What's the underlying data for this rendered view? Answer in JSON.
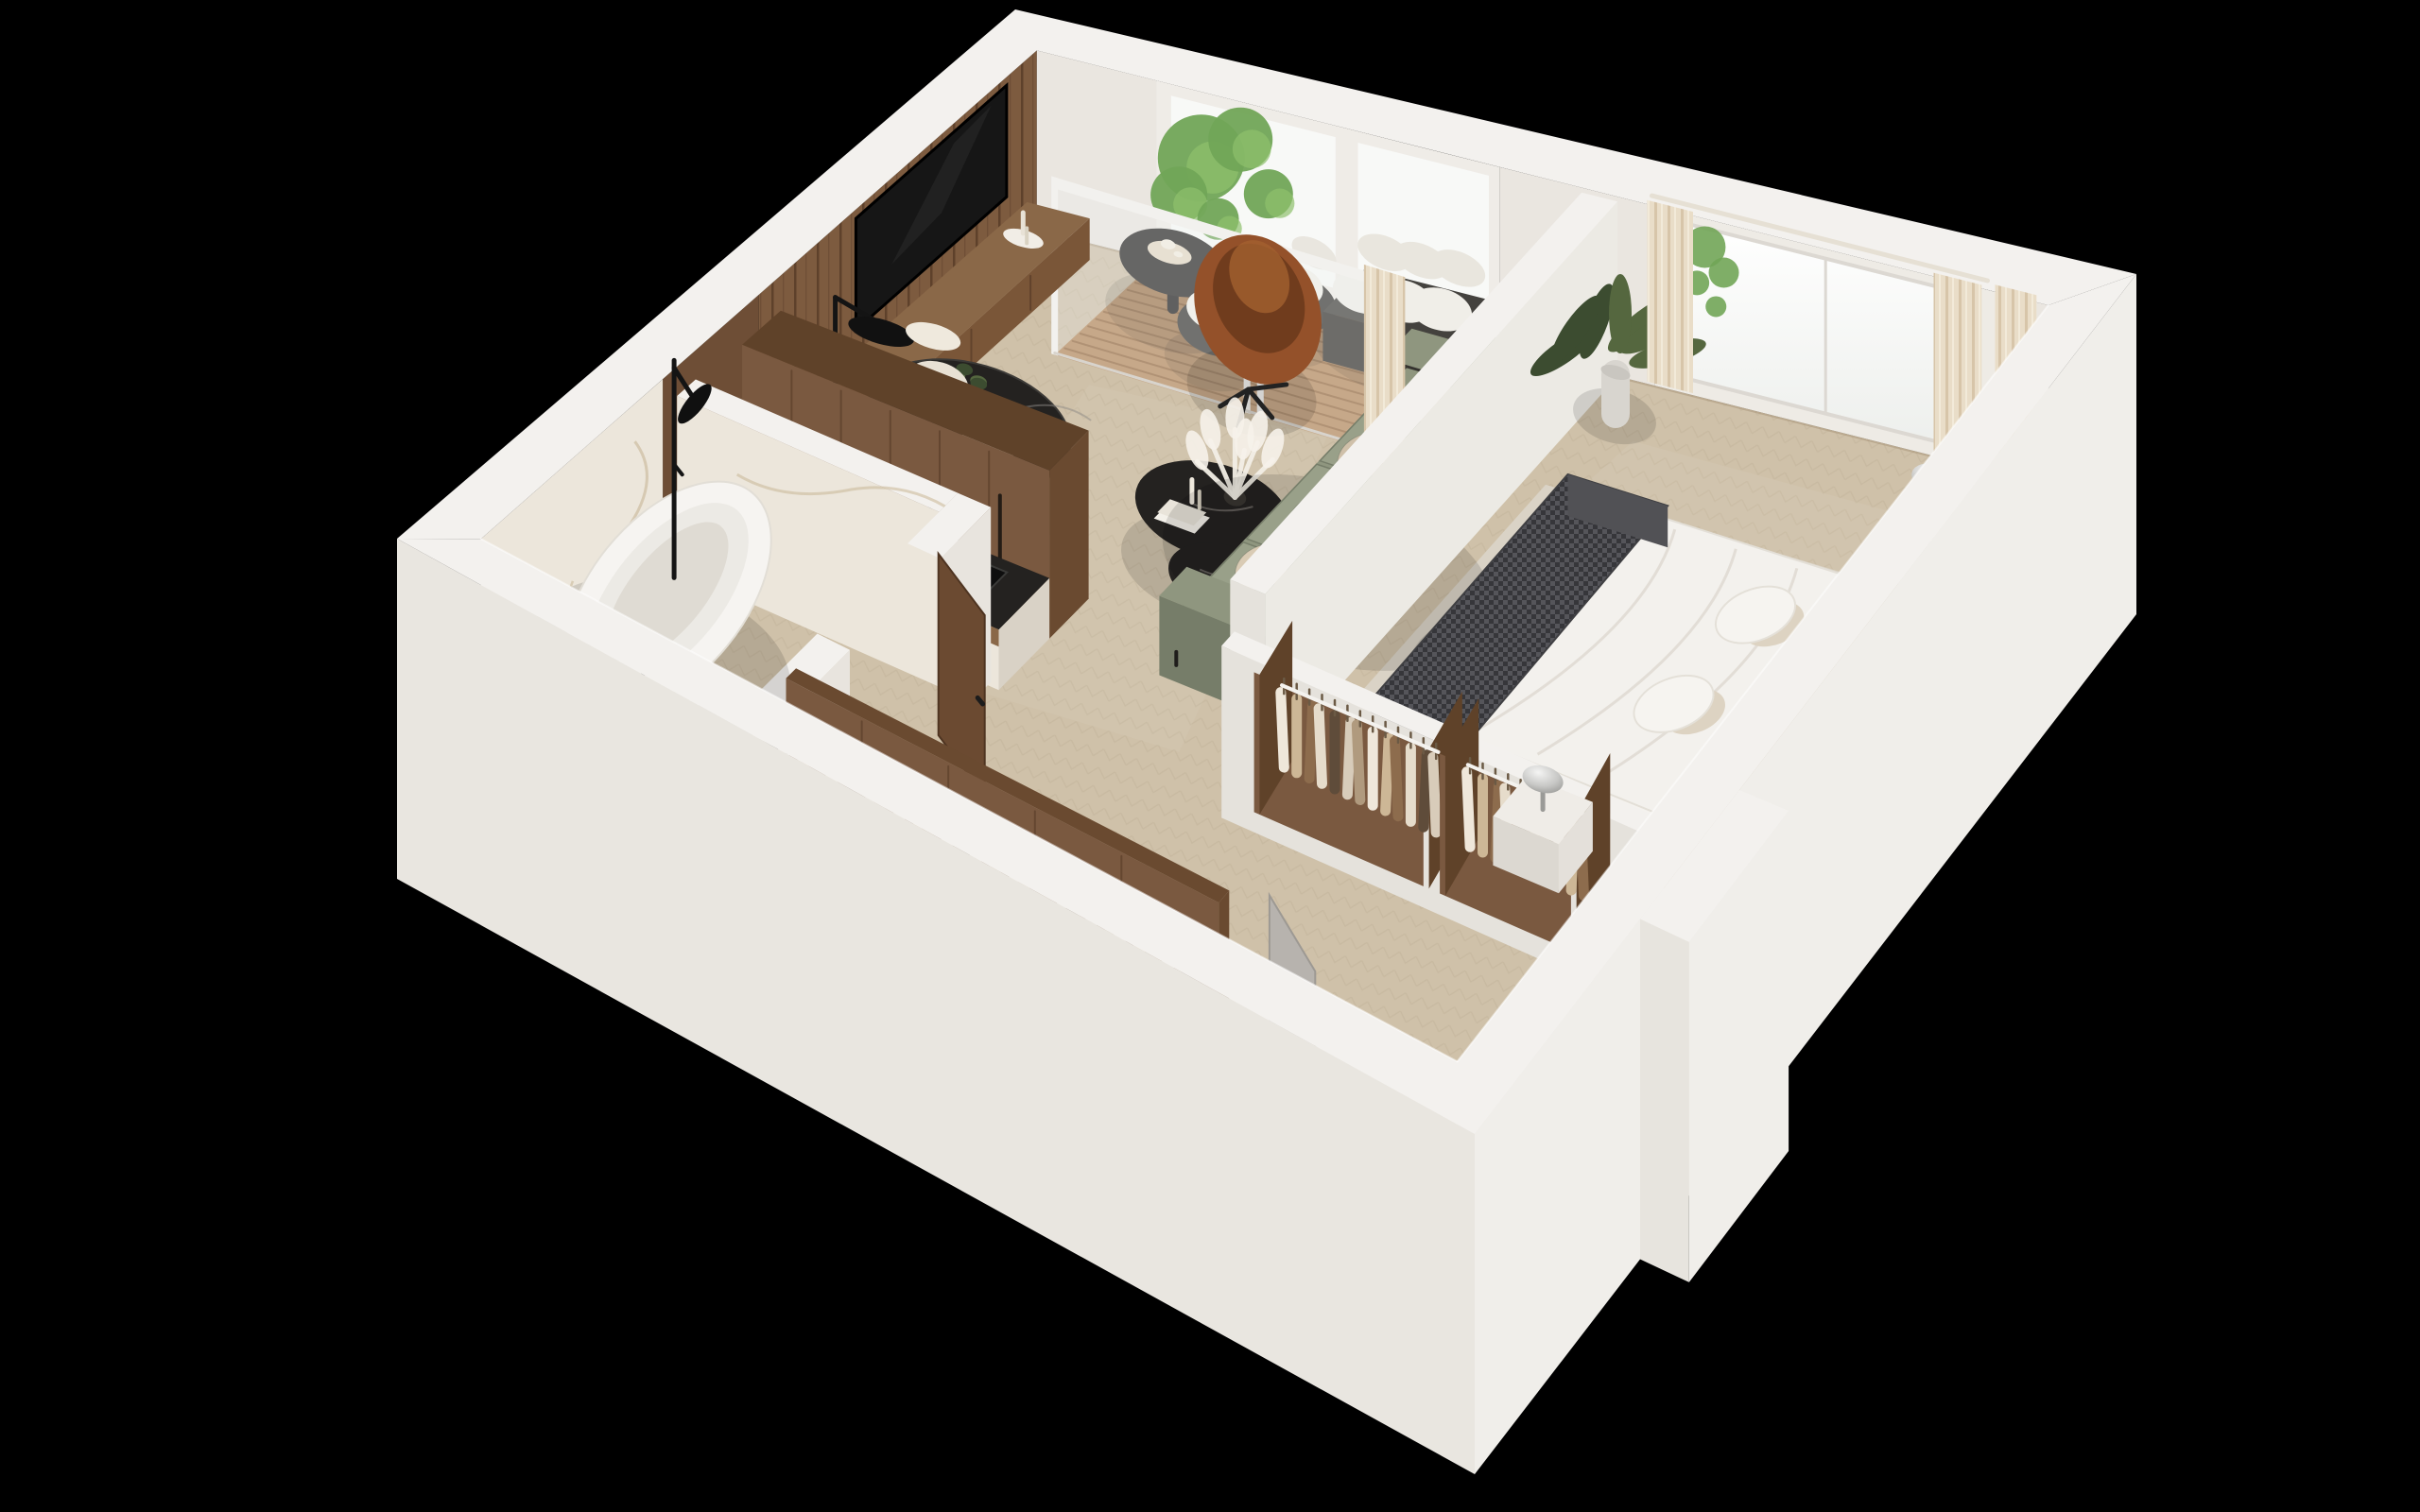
{
  "meta": {
    "title": "3D cutaway floor plan render of a one-bedroom apartment",
    "view": "axonometric top-down cutaway",
    "background": "#000000",
    "visible_text": "none"
  },
  "palette": {
    "background": "#000000",
    "wall_top": "#f3f1ee",
    "wall_inner": "#eae6e0",
    "wall_inner_warm": "#e7ddd0",
    "wall_outer_se": "#f0eeea",
    "wall_outer_sw": "#e9e6e0",
    "floor": "#cfc1a9",
    "floor_line": "#b4a489",
    "rug": "#dad3c6",
    "deck": "#b5885c",
    "deck_line": "#8f6239",
    "wood_slat": "#7d5b3f",
    "wood_cabinet": "#7a5940",
    "wood_trim": "#8a6848",
    "wood_door": "#6b4a31",
    "marble_white": "#ece6db",
    "marble_vein": "#c8b696",
    "marble_black": "#242220",
    "tv_screen": "#161616",
    "sofa_green": "#8f967f",
    "sofa_green_dark": "#767d69",
    "pillow_beige": "#d9cbb4",
    "leather_cognac": "#94512a",
    "leather_dark": "#703c1d",
    "curtain_cream": "#e9ddc8",
    "bed_white": "#f4f2ee",
    "duvet_fold": "#ddd8d0",
    "throw_charcoal": "#4a4a4e",
    "headboard_beige": "#cfc2ae",
    "chrome": "#c9c9c7",
    "plant_green": "#55673f",
    "plant_dark": "#3c4c30",
    "tree_green": "#71a557",
    "tree_light": "#8fc06c",
    "sanitary_white": "#f6f4f1",
    "black_fixture": "#141414",
    "door_gray": "#b7b3ae",
    "glass": "rgba(238,242,241,0.30)"
  },
  "scene": {
    "rooms": [
      {
        "id": "living-room",
        "label": "Living room",
        "items": [
          "wood-slat-tv-wall",
          "wall-mounted-tv",
          "wood-media-console",
          "black-arc-floor-lamp",
          "cognac-leather-egg-chair",
          "black-marble-round-dining-table",
          "cream-boucle-dining-chairs",
          "table-setting-plates",
          "black-marble-coffee-table-duo",
          "pampas-grass-vase",
          "sage-green-sofa",
          "beige-throw-pillows",
          "cream-curtain-panel",
          "herringbone-oak-floor"
        ]
      },
      {
        "id": "kitchen",
        "label": "Kitchen",
        "items": [
          "walnut-tall-cabinets",
          "black-marble-countertop",
          "induction-hob",
          "black-undermount-sink",
          "white-marble-island-front",
          "ceramic-tea-set"
        ]
      },
      {
        "id": "bedroom",
        "label": "Bedroom",
        "items": [
          "upholstered-bed",
          "white-duvet",
          "houndstooth-throw-blanket",
          "beige-headboard",
          "white-and-beige-pillows",
          "nightstands",
          "chrome-mushroom-lamps",
          "beige-area-rug",
          "banana-leaf-plant",
          "bright-window",
          "cream-curtains",
          "open-wardrobe-bays",
          "hanging-clothes"
        ]
      },
      {
        "id": "bathroom",
        "label": "Bathroom",
        "items": [
          "white-marble-walls",
          "freestanding-oval-bathtub",
          "black-shower-column",
          "black-marble-vanity",
          "round-vessel-basin",
          "toilet",
          "walnut-door"
        ]
      },
      {
        "id": "hallway",
        "label": "Hallway entry",
        "items": [
          "open-closet-rail",
          "hanging-clothes",
          "gray-entry-door",
          "herringbone-oak-floor"
        ]
      },
      {
        "id": "balcony",
        "label": "Balcony",
        "items": [
          "wood-deck-boards",
          "black-round-bistro-table",
          "rattan-lounge-chairs",
          "outdoor-sofa-white-cushions",
          "green-tree-foliage",
          "glass-sliding-door"
        ]
      }
    ]
  }
}
